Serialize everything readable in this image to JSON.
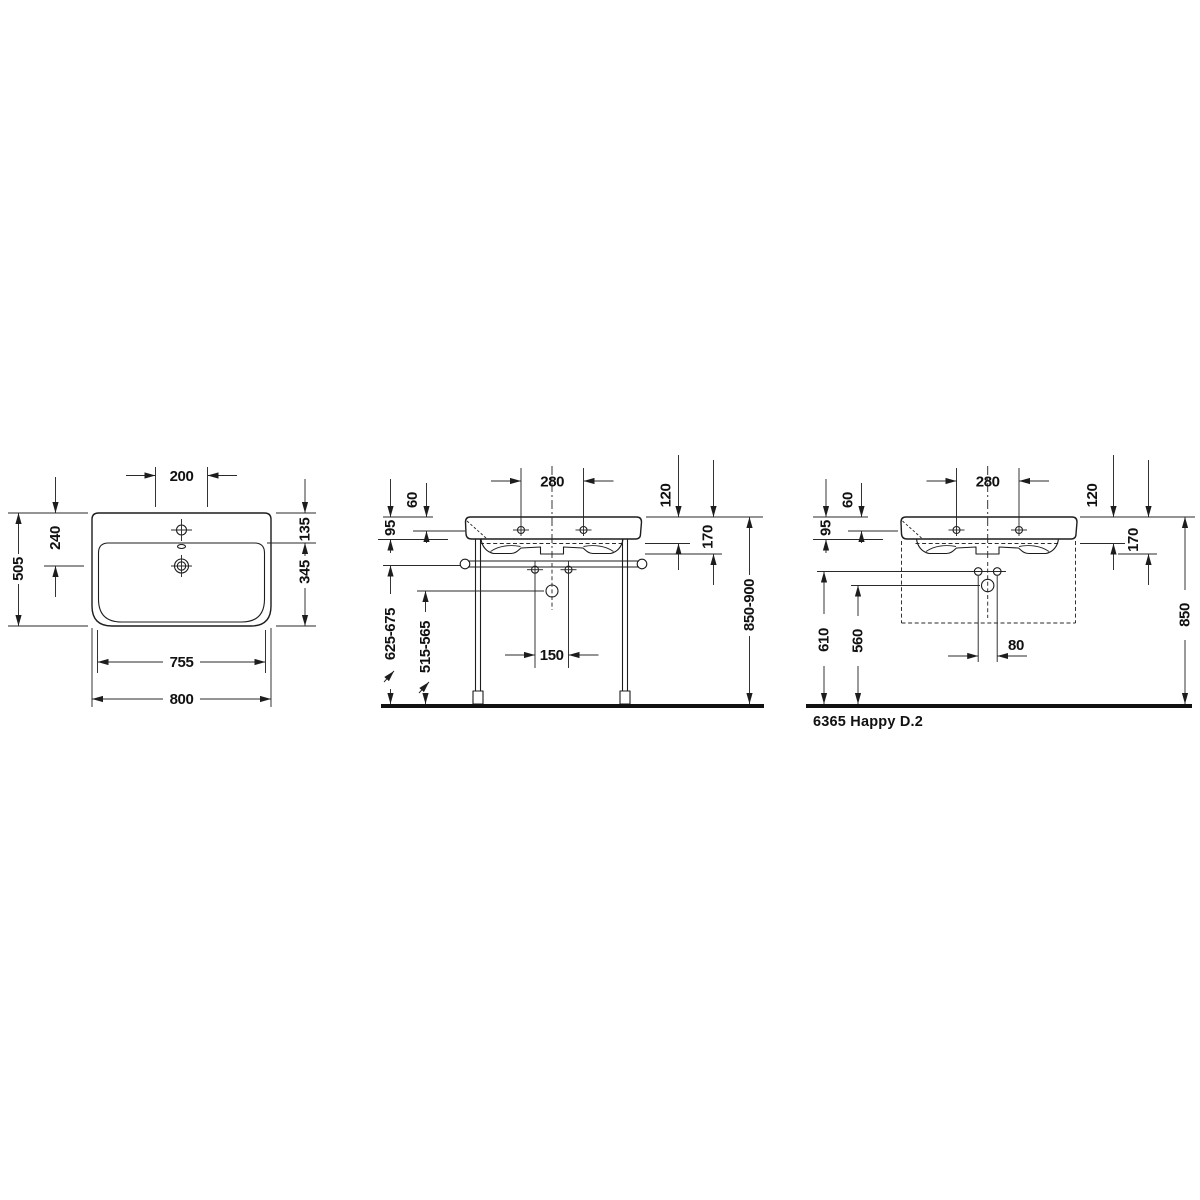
{
  "product": {
    "label": "6365 Happy D.2"
  },
  "colors": {
    "line": "#1d1d1d",
    "background": "#ffffff",
    "text": "#111111"
  },
  "views": {
    "plan": {
      "title": "top view washbasin",
      "dims": {
        "faucet_width": "200",
        "top_to_drain": "240",
        "depth_total": "505",
        "rim_to_bowl": "135",
        "bowl_depth": "345",
        "bowl_width": "755",
        "width_total": "800"
      }
    },
    "console": {
      "title": "front view with console stand",
      "dims": {
        "hole_spacing": "280",
        "rim_to_inner": "60",
        "rim_to_apron": "95",
        "rim_to_back_bottom": "120",
        "rim_to_underside": "170",
        "rail_height": "625-675",
        "drain_height": "515-565",
        "lower_hole_spacing": "150",
        "rim_height": "850-900"
      }
    },
    "wall": {
      "title": "front view wall mounted",
      "dims": {
        "hole_spacing": "280",
        "rim_to_inner": "60",
        "rim_to_apron": "95",
        "rim_to_back_bottom": "120",
        "rim_to_underside": "170",
        "fixing_height": "610",
        "drain_height": "560",
        "fixing_spacing": "80",
        "rim_height": "850"
      }
    }
  }
}
